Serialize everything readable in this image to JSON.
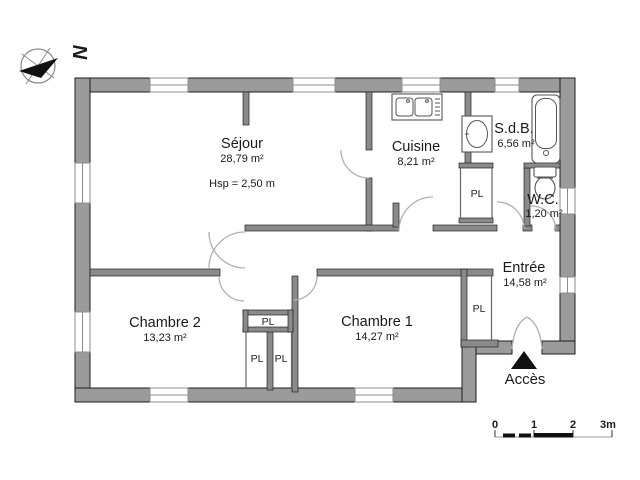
{
  "compass": {
    "letter": "N"
  },
  "rooms": {
    "sejour": {
      "name": "Séjour",
      "area": "28,79 m²",
      "ceiling_note": "Hsp = 2,50 m"
    },
    "cuisine": {
      "name": "Cuisine",
      "area": "8,21 m²"
    },
    "sdb": {
      "name": "S.d.B.",
      "area": "6,56 m²"
    },
    "wc": {
      "name": "W.C.",
      "area": "1,20 m²"
    },
    "entree": {
      "name": "Entrée",
      "area": "14,58 m²"
    },
    "chambre1": {
      "name": "Chambre 1",
      "area": "14,27 m²"
    },
    "chambre2": {
      "name": "Chambre 2",
      "area": "13,23 m²"
    }
  },
  "closet_label": "PL",
  "access_label": "Accès",
  "scale_bar": {
    "ticks": [
      "0",
      "1",
      "2",
      "3m"
    ]
  },
  "colors": {
    "exterior_wall": "#9b9b9b",
    "interior_wall": "#8a8a8a",
    "outline": "#1c1c1c",
    "door_arc": "#b0b0b0",
    "text": "#1a1a1a",
    "background": "#ffffff"
  }
}
